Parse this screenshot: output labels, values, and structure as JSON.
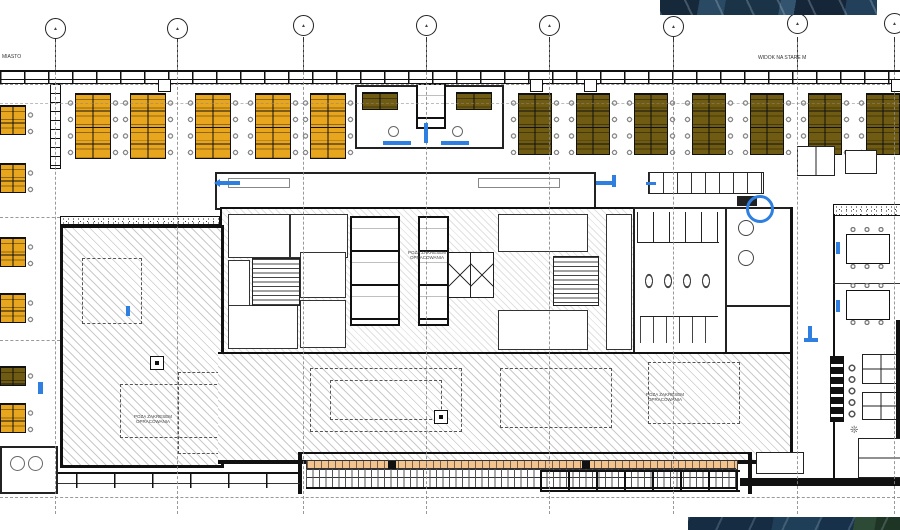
{
  "drawing": {
    "type": "architectural-floor-plan",
    "labels": {
      "top_left": "MIASTO",
      "top_right": "WIDOK NA STARE M",
      "scope_line1": "POZA ZAKRESEM",
      "scope_line2": "OPRACOWANIA"
    },
    "grid": {
      "bubble_label": "▲",
      "bubble_count": 8
    },
    "icons": {
      "plant": "❊"
    },
    "colors": {
      "desk_yellow": "#E8A61E",
      "desk_olive": "#6F5B11",
      "annotation_blue": "#2E7FE0",
      "terrace_orange": "#F2C38F",
      "wall_black": "#111111",
      "photo_navy": "#1B3347",
      "photo_green": "#2D4A36"
    }
  }
}
